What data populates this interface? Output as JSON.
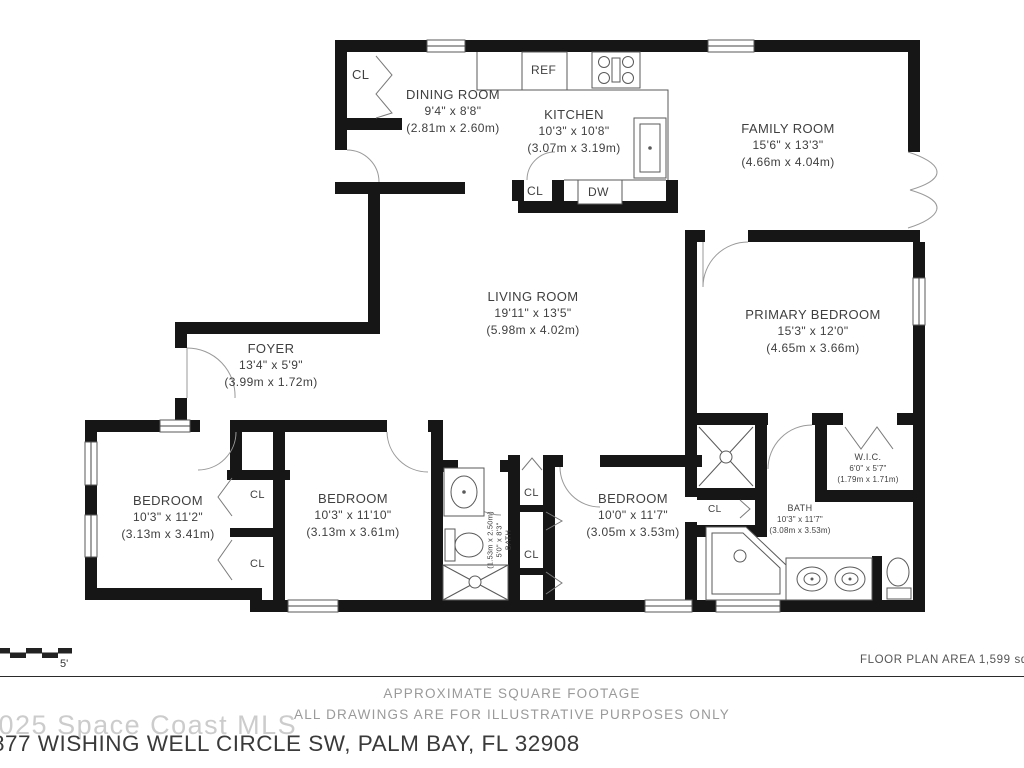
{
  "plan": {
    "rooms": {
      "dining": {
        "name": "DINING ROOM",
        "imperial": "9'4\" x 8'8\"",
        "metric": "(2.81m x 2.60m)"
      },
      "kitchen": {
        "name": "KITCHEN",
        "imperial": "10'3\" x 10'8\"",
        "metric": "(3.07m x 3.19m)"
      },
      "family": {
        "name": "FAMILY ROOM",
        "imperial": "15'6\" x 13'3\"",
        "metric": "(4.66m x 4.04m)"
      },
      "living": {
        "name": "LIVING ROOM",
        "imperial": "19'11\" x 13'5\"",
        "metric": "(5.98m x 4.02m)"
      },
      "primary": {
        "name": "PRIMARY BEDROOM",
        "imperial": "15'3\" x 12'0\"",
        "metric": "(4.65m x 3.66m)"
      },
      "foyer": {
        "name": "FOYER",
        "imperial": "13'4\" x 5'9\"",
        "metric": "(3.99m x 1.72m)"
      },
      "bedroom1": {
        "name": "BEDROOM",
        "imperial": "10'3\" x 11'2\"",
        "metric": "(3.13m x 3.41m)"
      },
      "bedroom2": {
        "name": "BEDROOM",
        "imperial": "10'3\" x 11'10\"",
        "metric": "(3.13m x 3.61m)"
      },
      "bedroom3": {
        "name": "BEDROOM",
        "imperial": "10'0\" x 11'7\"",
        "metric": "(3.05m x 3.53m)"
      },
      "hall_bath": {
        "name": "BATH",
        "imperial": "5'0\" x 8'3\"",
        "metric": "(1.53m x 2.50m)"
      },
      "primary_bath": {
        "name": "BATH",
        "imperial": "10'3\" x 11'7\"",
        "metric": "(3.08m x 3.53m)"
      },
      "wic": {
        "name": "W.I.C.",
        "imperial": "6'0\" x 5'7\"",
        "metric": "(1.79m x 1.71m)"
      }
    },
    "fixtures": {
      "refrigerator": "REF",
      "dishwasher": "DW",
      "closet": "CL"
    },
    "scale": {
      "label": "5'",
      "origin": "0'"
    }
  },
  "footer": {
    "area": "FLOOR PLAN AREA 1,599 sq.ft.",
    "disclaimer1": "APPROXIMATE SQUARE FOOTAGE",
    "disclaimer2": "ALL DRAWINGS ARE FOR ILLUSTRATIVE PURPOSES ONLY",
    "watermark": "2025 Space Coast MLS",
    "address": "877 WISHING WELL CIRCLE SW, PALM BAY, FL 32908"
  },
  "colors": {
    "wall": "#161616",
    "text": "#3f3f3f",
    "muted": "#9a9a9a",
    "watermark": "#cccccc"
  }
}
